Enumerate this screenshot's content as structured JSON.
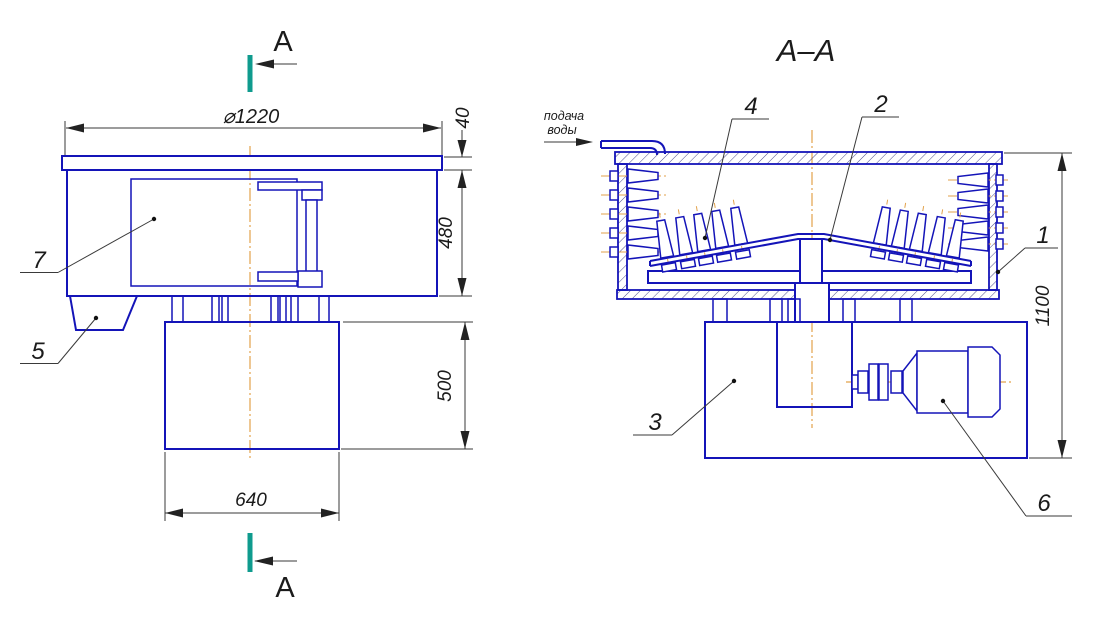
{
  "drawing": {
    "section_title": "A–A",
    "section_marker": {
      "top_letter": "A",
      "bottom_letter": "A"
    },
    "water_note": {
      "line1": "подача",
      "line2": "воды"
    },
    "dimensions": {
      "diameter": "⌀1220",
      "flange_height": "40",
      "body_height": "480",
      "pedestal_height": "500",
      "pedestal_width": "640",
      "total_height": "1100"
    },
    "part_labels": {
      "p1": "1",
      "p2": "2",
      "p3": "3",
      "p4": "4",
      "p5": "5",
      "p6": "6",
      "p7": "7"
    },
    "colors": {
      "line_blue": "#1414b8",
      "centerline_orange": "#e2a24b",
      "section_teal": "#0f9b8e",
      "dimension_black": "#3a3a3a"
    }
  }
}
